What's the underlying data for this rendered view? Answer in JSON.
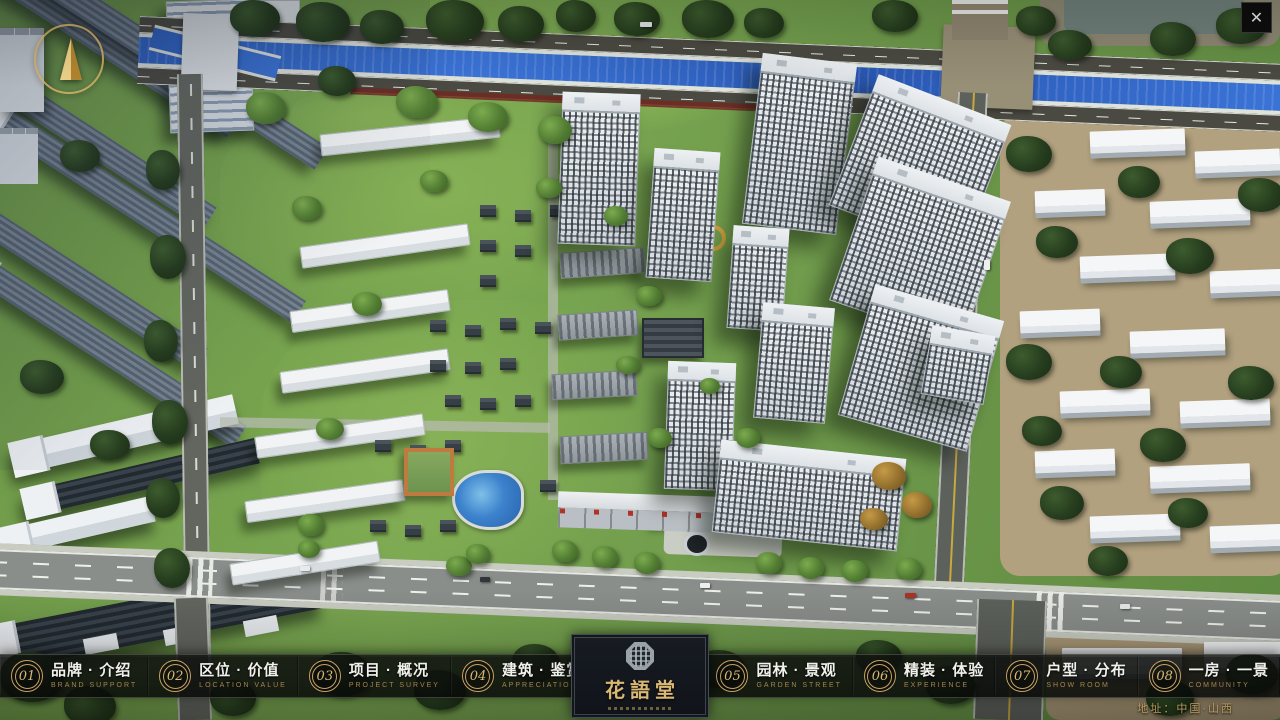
{
  "window": {
    "close_glyph": "✕"
  },
  "nav": {
    "items": [
      {
        "num": "01",
        "zh": "品牌 · 介绍",
        "en": "BRAND SUPPORT"
      },
      {
        "num": "02",
        "zh": "区位 · 价值",
        "en": "LOCATION VALUE"
      },
      {
        "num": "03",
        "zh": "项目 · 概况",
        "en": "PROJECT SURVEY"
      },
      {
        "num": "04",
        "zh": "建筑 · 鉴赏",
        "en": "APPRECIATION"
      },
      {
        "num": "05",
        "zh": "园林 · 景观",
        "en": "GARDEN STREET"
      },
      {
        "num": "06",
        "zh": "精装 · 体验",
        "en": "EXPERIENCE"
      },
      {
        "num": "07",
        "zh": "户型 · 分布",
        "en": "SHOW ROOM"
      },
      {
        "num": "08",
        "zh": "一房 · 一景",
        "en": "COMMUNITY"
      }
    ]
  },
  "logo": {
    "name": "花語堂"
  },
  "footer": {
    "address": "地址：中国·山西"
  },
  "colors": {
    "gold": "#c9a262",
    "river": "#2f63c6",
    "grass": "#6f9a49",
    "bar_bg": "rgba(10,12,10,0.8)"
  }
}
